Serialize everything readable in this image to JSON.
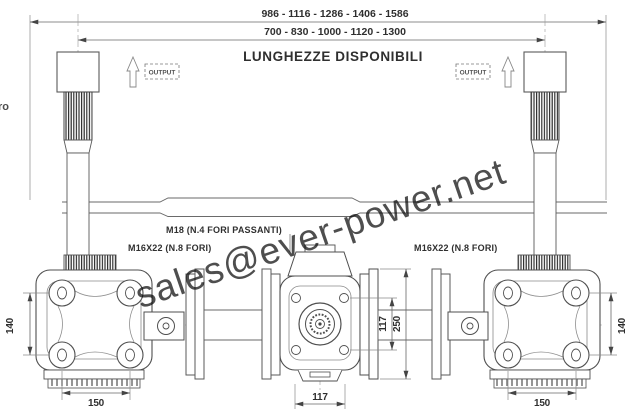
{
  "drawing": {
    "heading": "LUNGHEZZE DISPONIBILI",
    "length_series_outer": "986 - 1116 - 1286 - 1406 - 1586",
    "length_series_inner": "700 - 830 - 1000 - 1120 - 1300",
    "output_left": "OUTPUT",
    "output_right": "OUTPUT",
    "label_m18": "M18  (N.4 FORI PASSANTI)",
    "label_m16_left": "M16X22  (N.8 FORI)",
    "label_m16_right": "M16X22  (N.8 FORI)",
    "edge_fragment": "ro",
    "dim_left_height": "140",
    "dim_right_height": "140",
    "dim_left_width": "150",
    "dim_right_width": "150",
    "dim_center_width": "117",
    "dim_center_holes": "117",
    "dim_center_height": "250",
    "watermark_text": "sales@ever-power.net",
    "colors": {
      "line": "#5a5a5a",
      "thin": "#8a8a8a",
      "dim": "#666666",
      "watermark": "#b5cfe9"
    }
  }
}
